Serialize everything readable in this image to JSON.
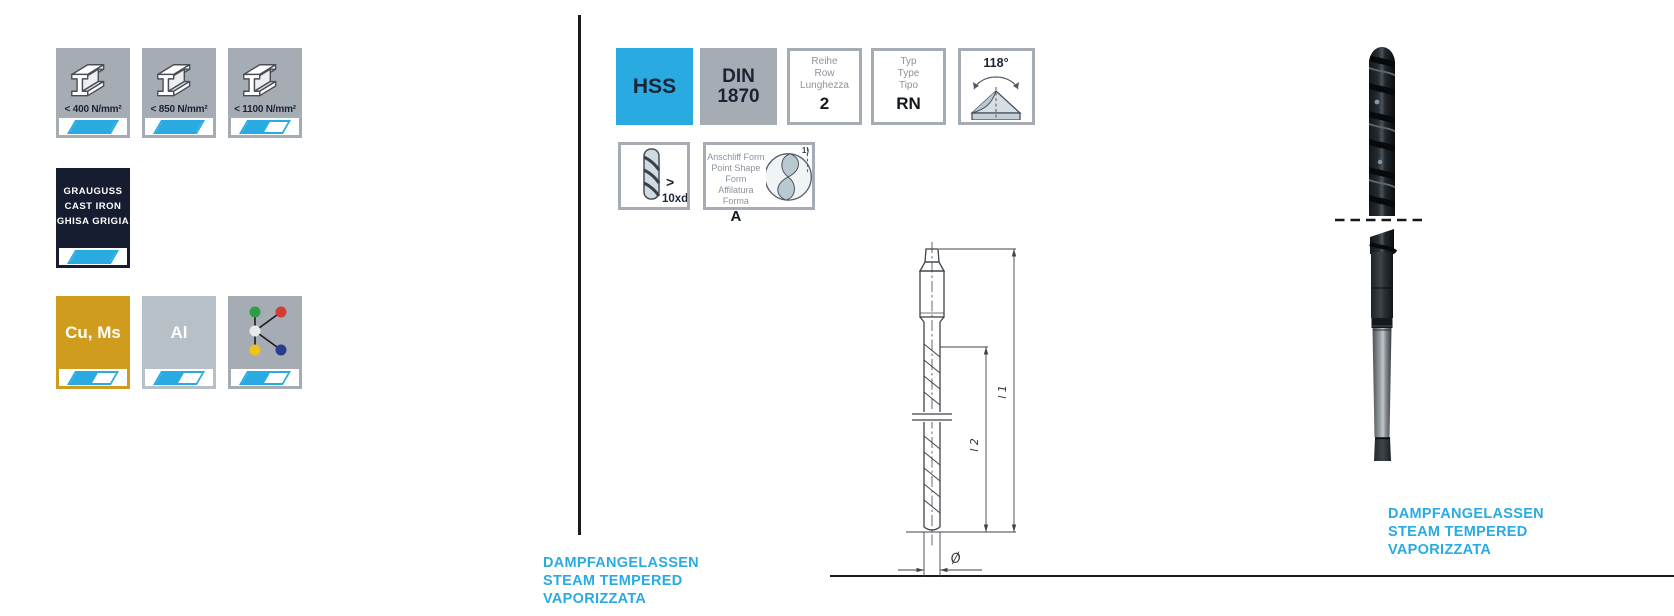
{
  "colors": {
    "accent_cyan": "#29ABE2",
    "dark_navy": "#1B2335",
    "box_gray": "#A6ACB4",
    "cast_iron_bg": "#161D30",
    "copper_gold": "#D09C1E",
    "aluminium_gray": "#B8C0C7"
  },
  "materials": {
    "steel": [
      {
        "label": "< 400 N/mm²",
        "fill": "full"
      },
      {
        "label": "< 850 N/mm²",
        "fill": "full"
      },
      {
        "label": "< 1100 N/mm²",
        "fill": "half"
      }
    ],
    "cast_iron": {
      "lines": [
        "GRAUGUSS",
        "CAST IRON",
        "GHISA GRIGIA"
      ],
      "fill": "full"
    },
    "non_ferrous": [
      {
        "label": "Cu, Ms",
        "fill": "half"
      },
      {
        "label": "Al",
        "fill": "half"
      },
      {
        "icon": "material-group-diagram",
        "fill": "half"
      }
    ]
  },
  "specs": {
    "material_grade": "HSS",
    "standard": {
      "line1": "DIN",
      "line2": "1870"
    },
    "series": {
      "labels": [
        "Reihe",
        "Row",
        "Lunghezza"
      ],
      "value": "2"
    },
    "type": {
      "labels": [
        "Typ",
        "Type",
        "Tipo"
      ],
      "value": "RN"
    },
    "point_angle": "118°",
    "depth_ratio": {
      "symbol": ">",
      "value": "10xd"
    },
    "point_shape": {
      "labels": [
        "Anschliff Form",
        "Point Shape Form",
        "Affilatura Forma"
      ],
      "value": "A",
      "footnote": "1)"
    }
  },
  "drawing": {
    "dim_l1": "l 1",
    "dim_l2": "l 2",
    "dim_diameter": "Ø"
  },
  "finish": {
    "left": [
      "DAMPFANGELASSEN",
      "STEAM TEMPERED",
      "VAPORIZZATA"
    ],
    "right": [
      "DAMPFANGELASSEN",
      "STEAM TEMPERED",
      "VAPORIZZATA"
    ]
  }
}
